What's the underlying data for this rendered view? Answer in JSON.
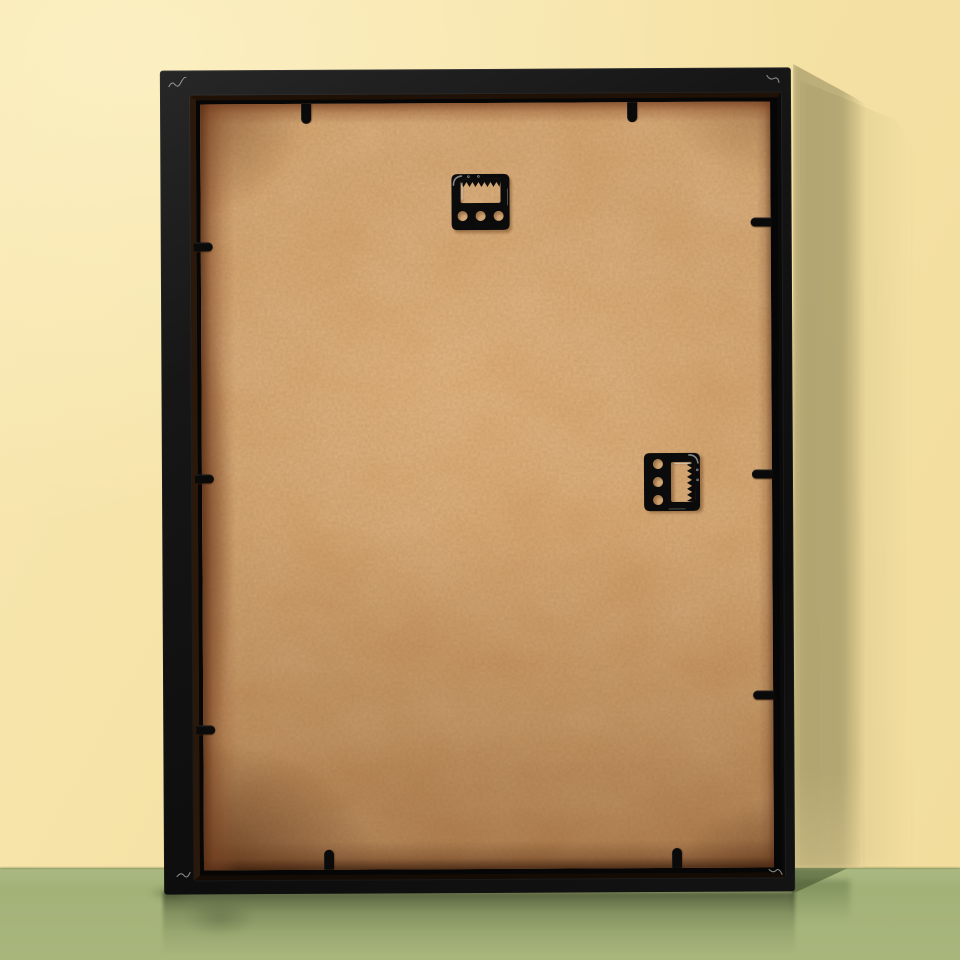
{
  "scene": {
    "description": "Back view of an empty black picture frame leaning upright against a pale yellow wall, standing on a glossy sage-green floor; the frame back shows a tan MDF backing board held by black metal retainer tabs, with two black sawtooth hangers screwed to the board, and a soft shadow cast on the wall to the right with a faint reflection on the floor below",
    "lighting": {
      "direction": "upper-left",
      "cast_shadow": "on wall to the right of the frame with diagonal upper edge",
      "reflection": "soft dark reflection of the frame on the glossy floor"
    },
    "palette": {
      "wall": "#f5e2a5",
      "wall_highlight": "#f9ecbe",
      "wall_shadow": "#cfc295",
      "floor": "#a3b478",
      "floor_shadow": "#8b9f67",
      "frame_black": "#141414",
      "frame_recess": "#060606",
      "backing_board": "#cf9d66",
      "backing_light_patch": "#dcab75",
      "backing_edge_shadow": "#6f3d1e",
      "hardware": "#0b0b0b",
      "hardware_shadow": "rgba(70,35,12,0.35)",
      "glint": "rgba(235,235,235,0.55)"
    },
    "frame": {
      "type": "picture-frame-back",
      "finish": "matte black with slight sheen",
      "backing_material": "tan MDF hardboard with fiber mottling and dark edge shadows"
    },
    "hardware": {
      "hangers": [
        {
          "type": "sawtooth-hanger",
          "position": "upper-center",
          "orientation": "horizontal",
          "teeth_edge": "top of slot",
          "screw_holes": 3,
          "holes_show_board": true
        },
        {
          "type": "sawtooth-hanger",
          "position": "middle-right",
          "orientation": "rotated-90-clockwise",
          "teeth_edge": "right of slot",
          "screw_holes": 3,
          "holes_show_board": true
        }
      ],
      "retainer_tabs": {
        "total": 10,
        "top": 2,
        "right": 3,
        "bottom": 2,
        "left": 3
      }
    },
    "details": {
      "corner_glints": 4,
      "corner_glint_style": "tiny wavy white scratch highlights on the black frame corners"
    }
  }
}
